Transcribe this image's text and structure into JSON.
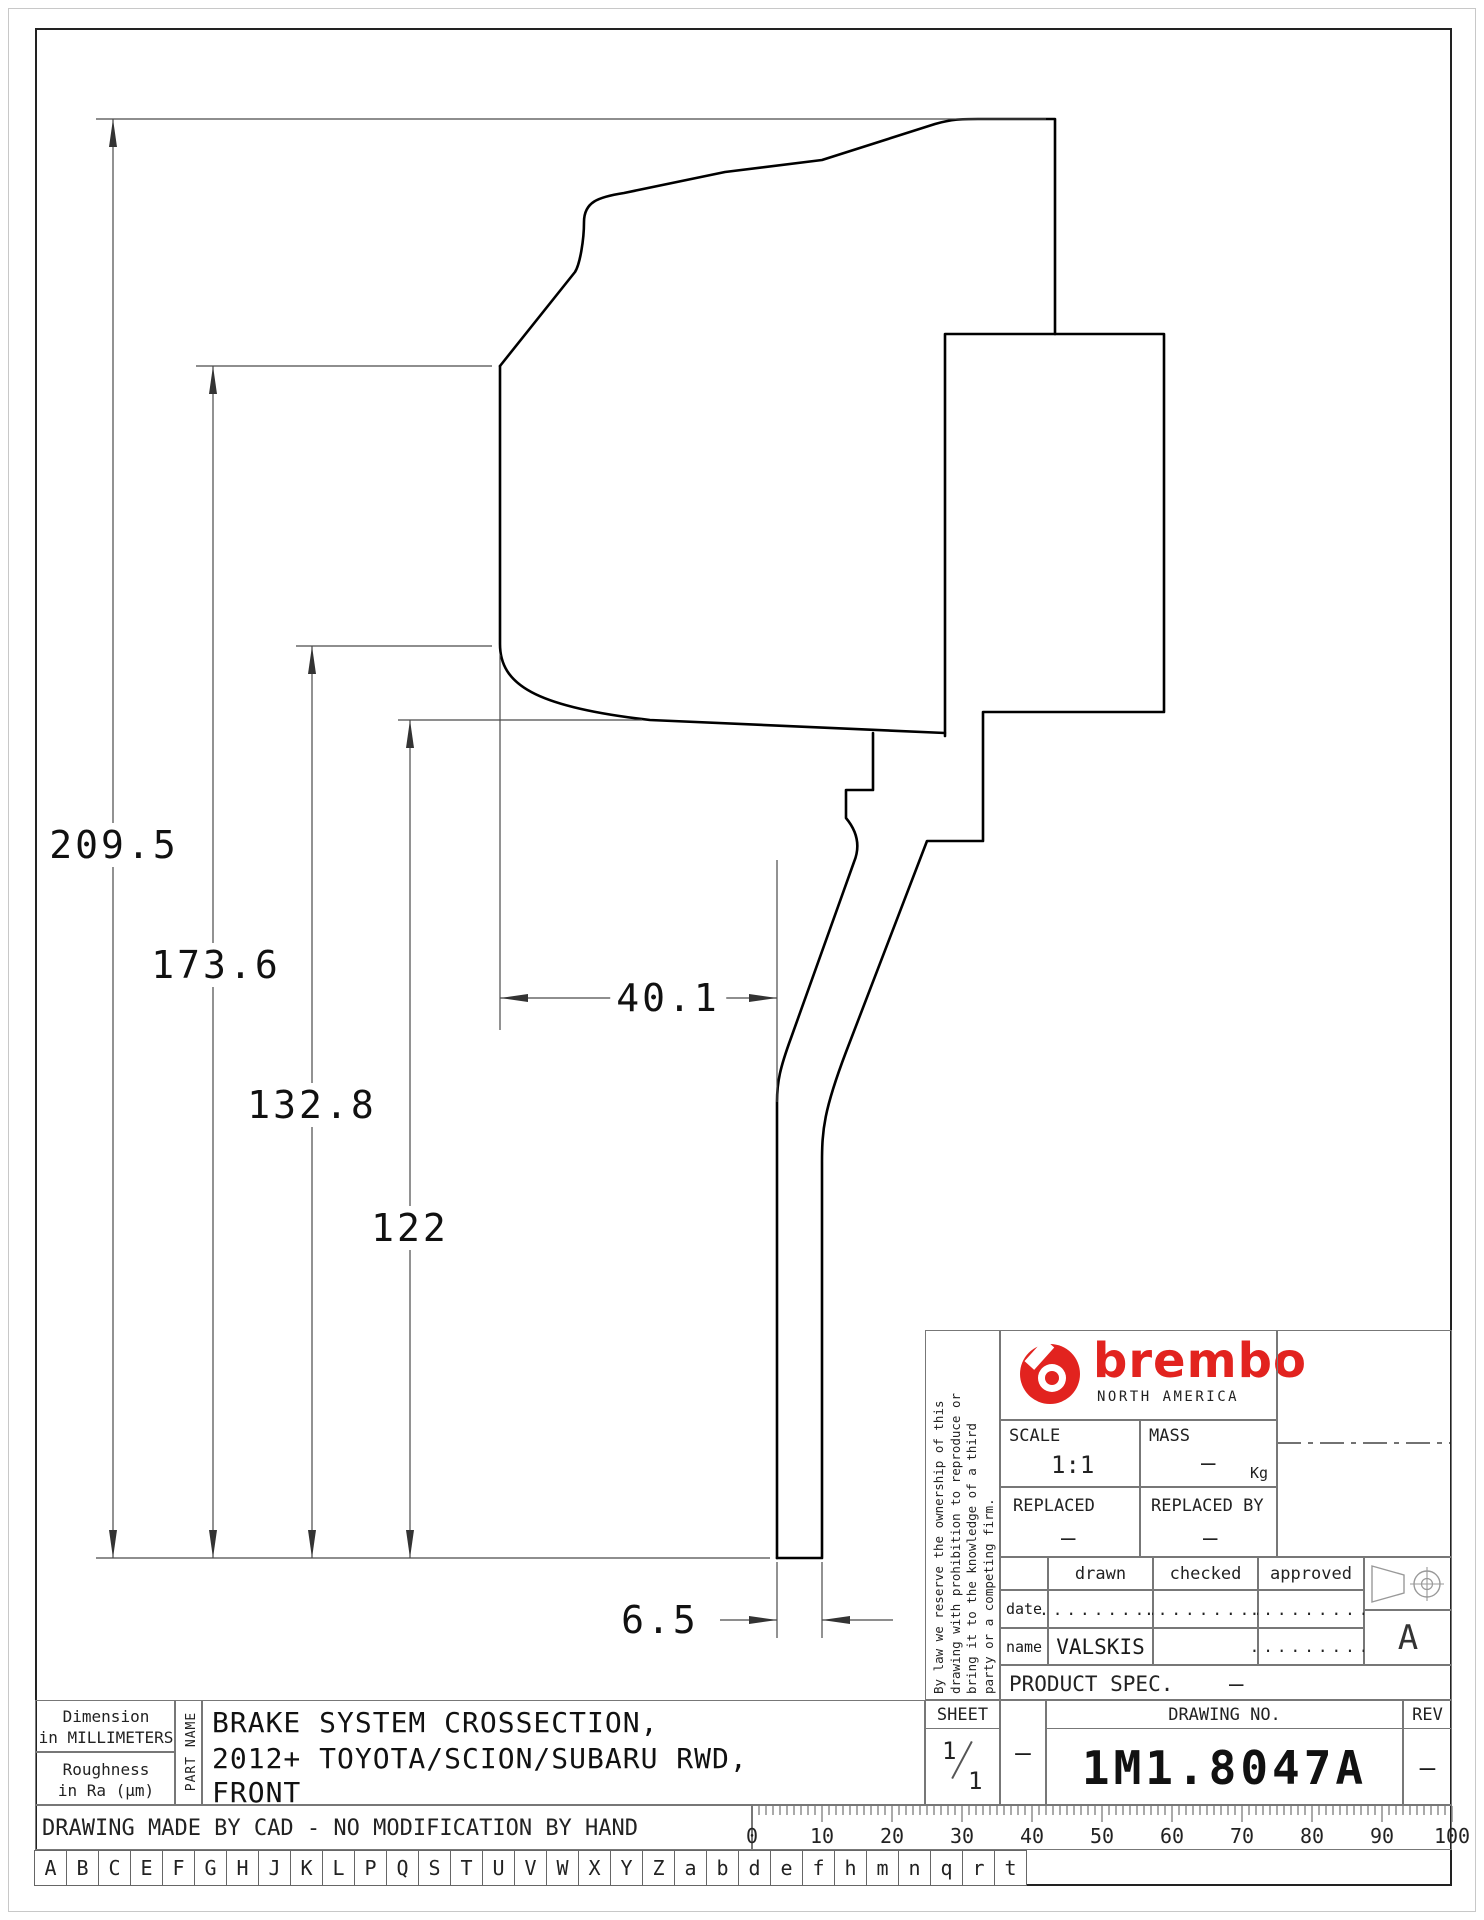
{
  "drawing": {
    "kind": "brake disc cross-section engineering drawing",
    "dimensions": {
      "overall_height": "209.5",
      "hat_height": "173.6",
      "mid_height": "132.8",
      "plate_height": "122",
      "hat_depth": "40.1",
      "plate_thickness": "6.5",
      "unit": "mm"
    }
  },
  "title_block": {
    "legal_lines": [
      "By law we reserve the ownership of this",
      "drawing with prohibition to reproduce or",
      "bring it to the knowledge of a third",
      "party or a competing firm."
    ],
    "brand": {
      "wordmark": "brembo",
      "region": "NORTH AMERICA",
      "color": "#e2231f"
    },
    "scale": {
      "label": "SCALE",
      "value": "1:1"
    },
    "mass": {
      "label": "MASS",
      "value": "–",
      "unit": "Kg"
    },
    "replaced": {
      "label": "REPLACED",
      "value": "–"
    },
    "replaced_by": {
      "label": "REPLACED BY",
      "value": "–"
    },
    "approval": {
      "columns": [
        "drawn",
        "checked",
        "approved"
      ],
      "date_label": "date",
      "name_label": "name",
      "date_values": [
        ".........",
        ".........",
        "........."
      ],
      "name_values": [
        "VALSKIS",
        "",
        "........."
      ]
    },
    "product_spec": {
      "label": "PRODUCT SPEC.",
      "value": "–"
    },
    "sheet": {
      "label": "SHEET",
      "numerator": "1",
      "denominator": "1"
    },
    "separator": "–",
    "drawing_no": {
      "label": "DRAWING NO.",
      "value": "1M1.8047A"
    },
    "rev": {
      "label": "REV",
      "value": "–"
    },
    "view_marker": "A"
  },
  "part_block": {
    "dimension_note_line1": "Dimension",
    "dimension_note_line2": "in MILLIMETERS",
    "roughness_note_line1": "Roughness",
    "roughness_note_line2": "in Ra (μm)",
    "part_name_label": "PART NAME",
    "part_name_lines": [
      "BRAKE SYSTEM CROSSECTION,",
      "2012+ TOYOTA/SCION/SUBARU RWD,",
      "FRONT"
    ]
  },
  "footer": {
    "cad_note": "DRAWING MADE BY CAD - NO MODIFICATION BY HAND",
    "ruler_numbers": [
      "0",
      "10",
      "20",
      "30",
      "40",
      "50",
      "60",
      "70",
      "80",
      "90",
      "100"
    ],
    "letters": [
      "A",
      "B",
      "C",
      "E",
      "F",
      "G",
      "H",
      "J",
      "K",
      "L",
      "P",
      "Q",
      "S",
      "T",
      "U",
      "V",
      "W",
      "X",
      "Y",
      "Z",
      "a",
      "b",
      "d",
      "e",
      "f",
      "h",
      "m",
      "n",
      "q",
      "r",
      "t"
    ]
  }
}
